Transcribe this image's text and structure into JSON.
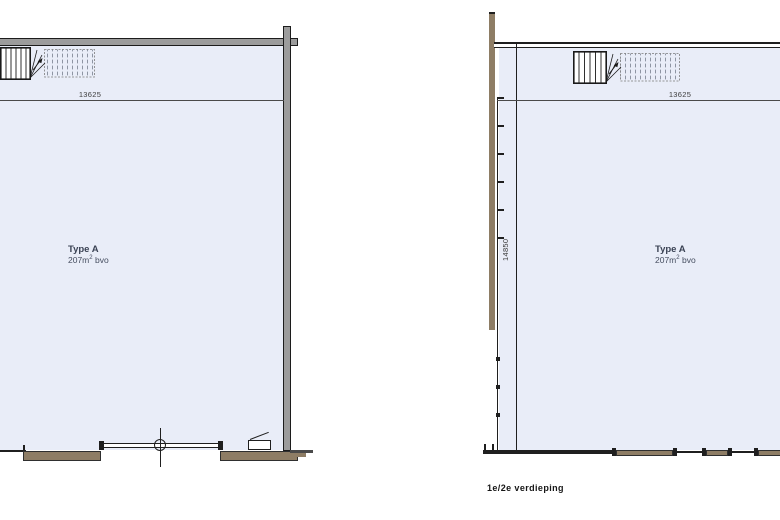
{
  "drawing": {
    "caption": "1e/2e verdieping",
    "plans": [
      {
        "name": "left-plan",
        "type_title": "Type A",
        "area_value": "207m",
        "area_sup": "2",
        "area_unit": " bvo",
        "dim_width": "13625"
      },
      {
        "name": "right-plan",
        "type_title": "Type A",
        "area_value": "207m",
        "area_sup": "2",
        "area_unit": " bvo",
        "dim_width": "13625",
        "dim_height": "14850"
      }
    ],
    "colors": {
      "floor_fill": "#e9edf8",
      "wall_grey": "#9c9c9c",
      "facade_brown": "#8e7d65",
      "line_dark": "#1f1f1f",
      "dim_text": "#3c3c3c",
      "type_text": "#3a4254",
      "hatch": "#8e95a3"
    }
  }
}
